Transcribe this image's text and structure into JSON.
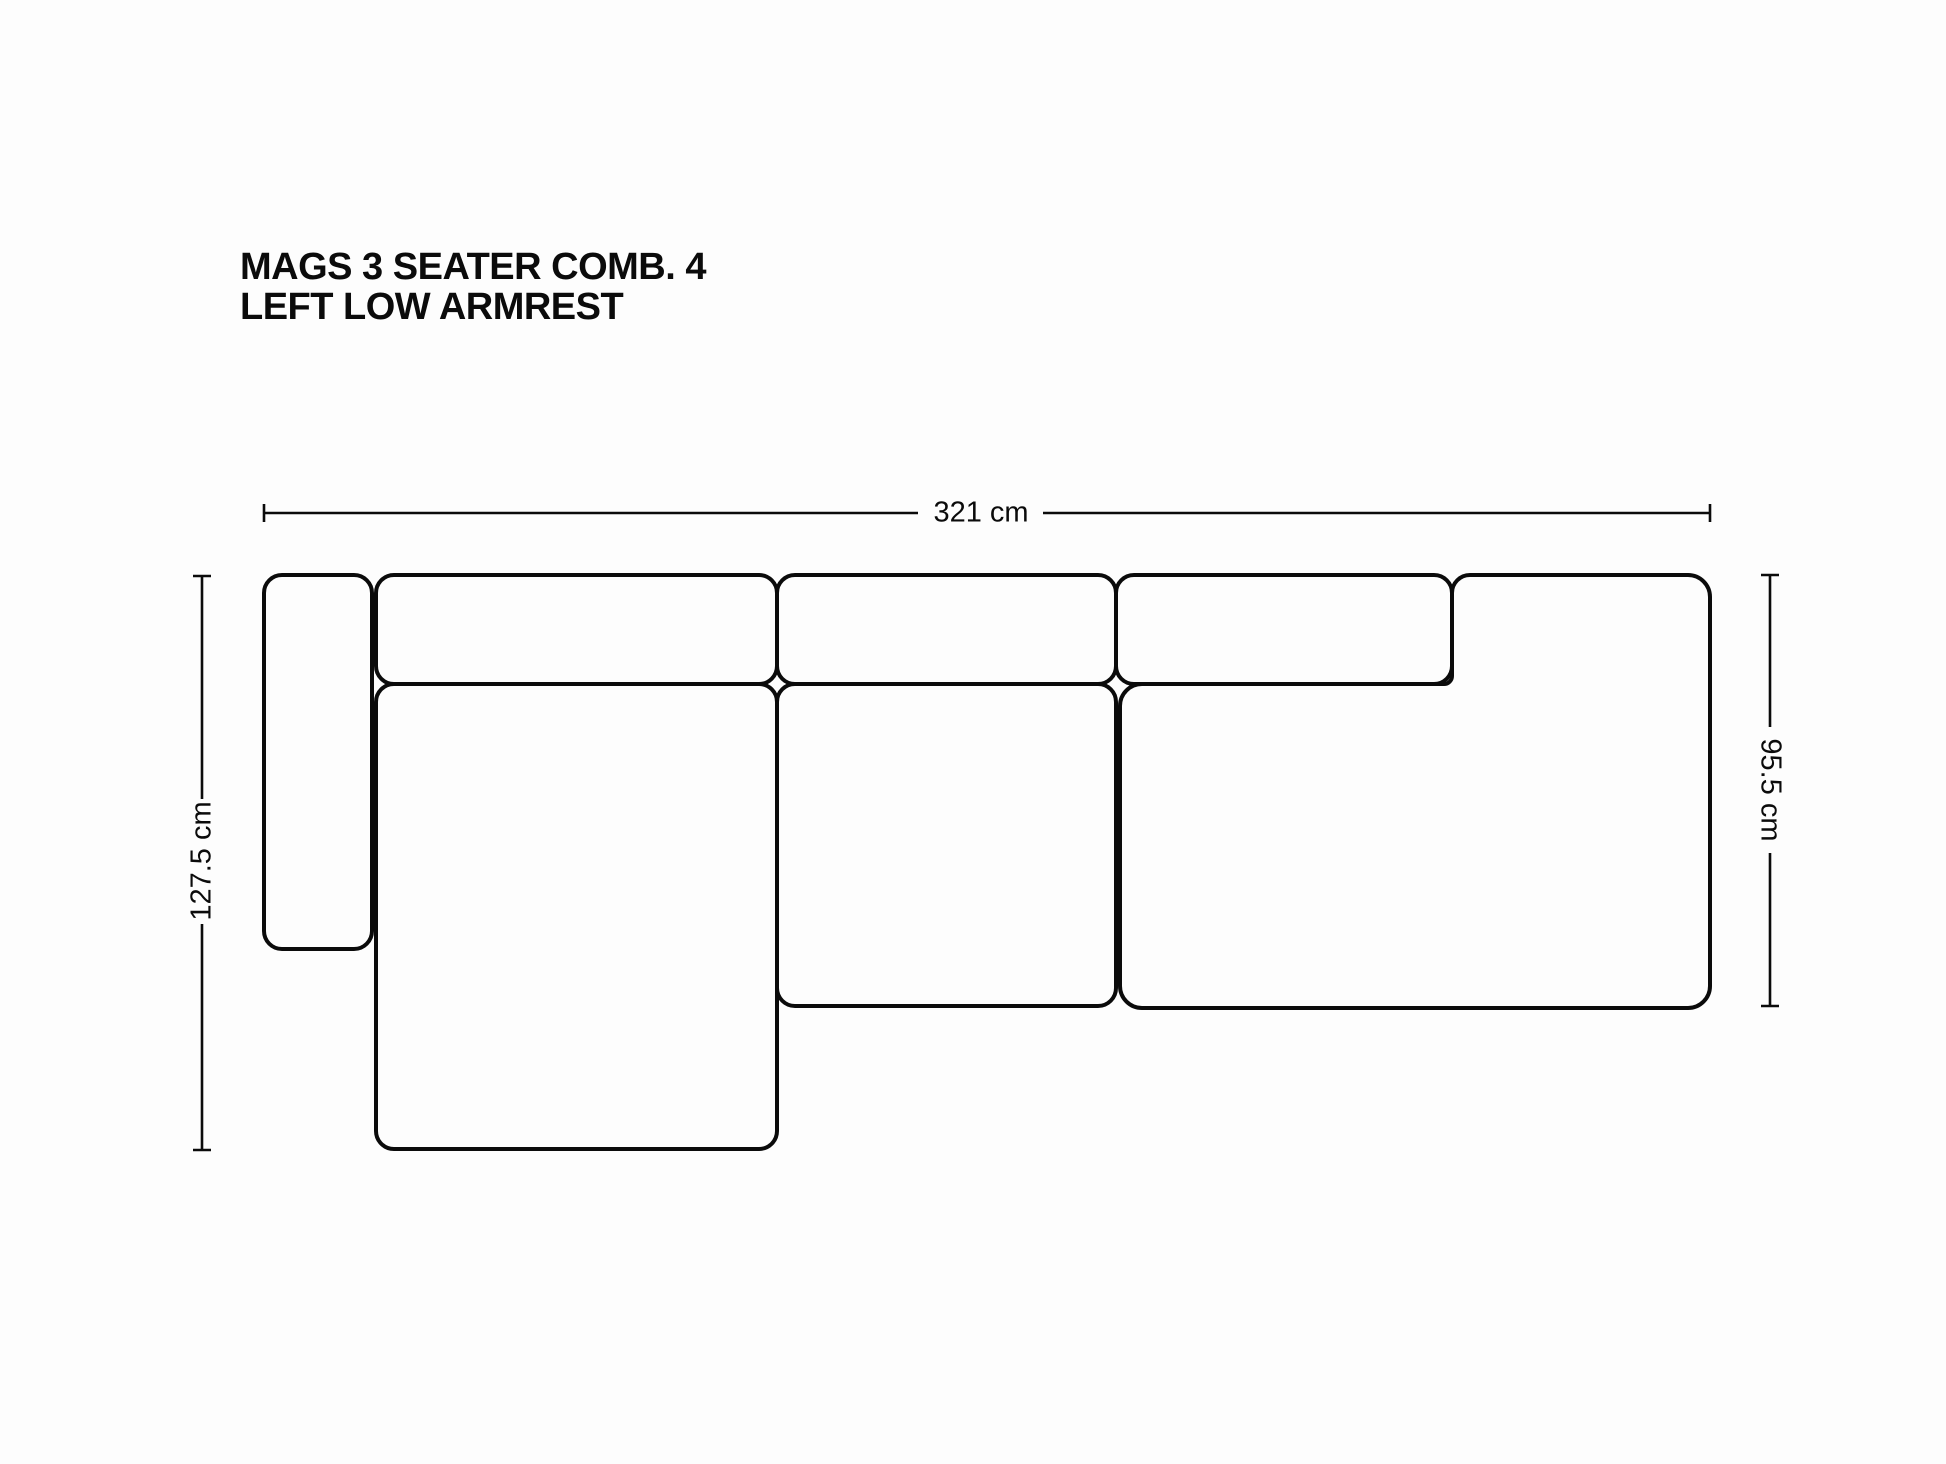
{
  "title": {
    "line1": "MAGS 3 SEATER COMB. 4",
    "line2": "LEFT LOW ARMREST"
  },
  "dimensions": {
    "width": {
      "label": "321 cm",
      "value_cm": 321,
      "orientation": "horizontal-top"
    },
    "height": {
      "label": "127.5 cm",
      "value_cm": 127.5,
      "orientation": "vertical-left"
    },
    "depth": {
      "label": "95.5 cm",
      "value_cm": 95.5,
      "orientation": "vertical-right"
    }
  },
  "figure": {
    "type": "technical-line-drawing",
    "subject": "modular sofa, top view",
    "panels": [
      "left-low-armrest",
      "backrest-band-1",
      "backrest-band-2",
      "backrest-band-3",
      "chaise-seat",
      "middle-seat",
      "right-corner-module"
    ]
  },
  "colors": {
    "line": "#0b0b0b",
    "text": "#0b0b0b",
    "background": "#fdfdfd"
  }
}
